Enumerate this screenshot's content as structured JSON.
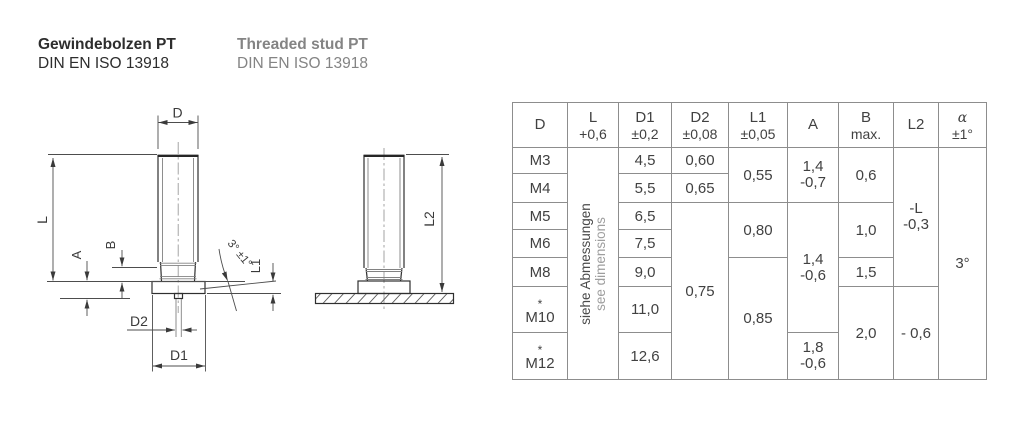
{
  "page": {
    "title_de": "Gewindebolzen PT",
    "standard_de": "DIN EN ISO 13918",
    "title_en": "Threaded stud PT",
    "standard_en": "DIN EN ISO 13918"
  },
  "drawing": {
    "labels": {
      "d": "D",
      "l": "L",
      "a": "A",
      "b": "B",
      "d2": "D2",
      "d1": "D1",
      "l1": "L1",
      "l2": "L2",
      "angle": "3° ±1°"
    }
  },
  "table": {
    "headers": [
      {
        "sym": "D",
        "tol": ""
      },
      {
        "sym": "L",
        "tol": "+0,6"
      },
      {
        "sym": "D1",
        "tol": "±0,2"
      },
      {
        "sym": "D2",
        "tol": "±0,08"
      },
      {
        "sym": "L1",
        "tol": "±0,05"
      },
      {
        "sym": "A",
        "tol": ""
      },
      {
        "sym": "B",
        "tol": "max."
      },
      {
        "sym": "L2",
        "tol": ""
      },
      {
        "sym": "α",
        "tol": "±1°"
      }
    ],
    "l_note": {
      "de": "siehe Abmessungen",
      "en": "see dimensions"
    },
    "star": "*",
    "rows": {
      "m3": {
        "d": "M3",
        "d1": "4,5",
        "d2": "0,60"
      },
      "m4": {
        "d": "M4",
        "d1": "5,5",
        "d2": "0,65"
      },
      "m5": {
        "d": "M5",
        "d1": "6,5"
      },
      "m6": {
        "d": "M6",
        "d1": "7,5"
      },
      "m8": {
        "d": "M8",
        "d1": "9,0"
      },
      "m10": {
        "d": "M10",
        "d1": "11,0"
      },
      "m12": {
        "d": "M12",
        "d1": "12,6"
      }
    },
    "merged": {
      "d2_m5_m12": "0,75",
      "l1_m3_m4": "0,55",
      "l1_m5_m6": "0,80",
      "l1_m8_m12": "0,85",
      "a_m3_m4": {
        "top": "1,4",
        "bot": "-0,7"
      },
      "a_m5_m10": {
        "top": "1,4",
        "bot": "-0,6"
      },
      "a_m12": {
        "top": "1,8",
        "bot": "-0,6"
      },
      "b_m3_m4": "0,6",
      "b_m5_m6": "1,0",
      "b_m8": "1,5",
      "b_m10_m12": "2,0",
      "l2_m3_m8": {
        "top": "-L",
        "bot": "-0,3"
      },
      "l2_m10_m12": "- 0,6",
      "alpha": "3°"
    }
  }
}
